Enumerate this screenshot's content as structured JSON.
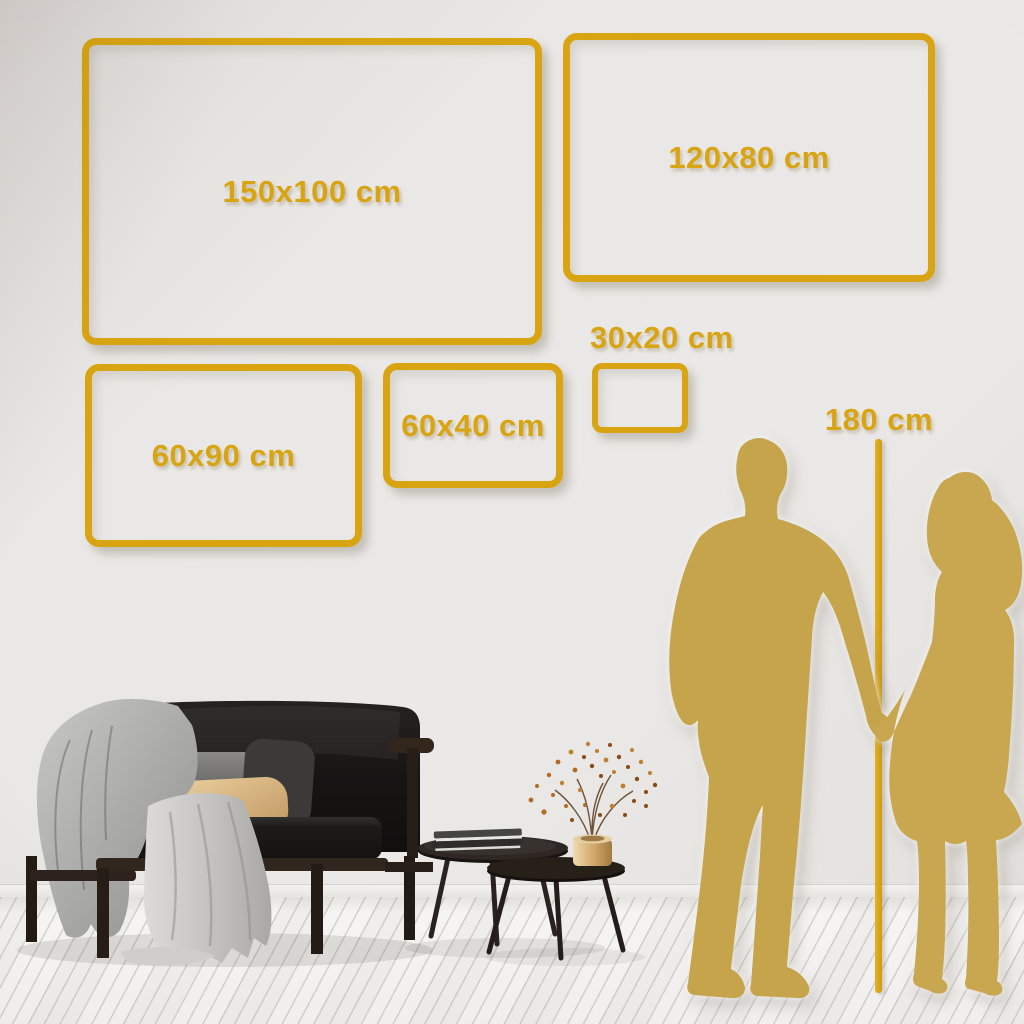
{
  "scene": {
    "frames": [
      {
        "size": "150x100",
        "label": "150x100 cm"
      },
      {
        "size": "120x80",
        "label": "120x80 cm"
      },
      {
        "size": "60x90",
        "label": "60x90 cm"
      },
      {
        "size": "60x40",
        "label": "60x40 cm"
      },
      {
        "size": "30x20",
        "label": "30x20 cm"
      }
    ],
    "ruler": {
      "label": "180 cm"
    },
    "colors": {
      "frame_gold": "#d9a412",
      "silhouette_gold": "#c6a44c",
      "wall_gray": "#eae8e6",
      "floor_white": "#f5f4f2"
    }
  }
}
